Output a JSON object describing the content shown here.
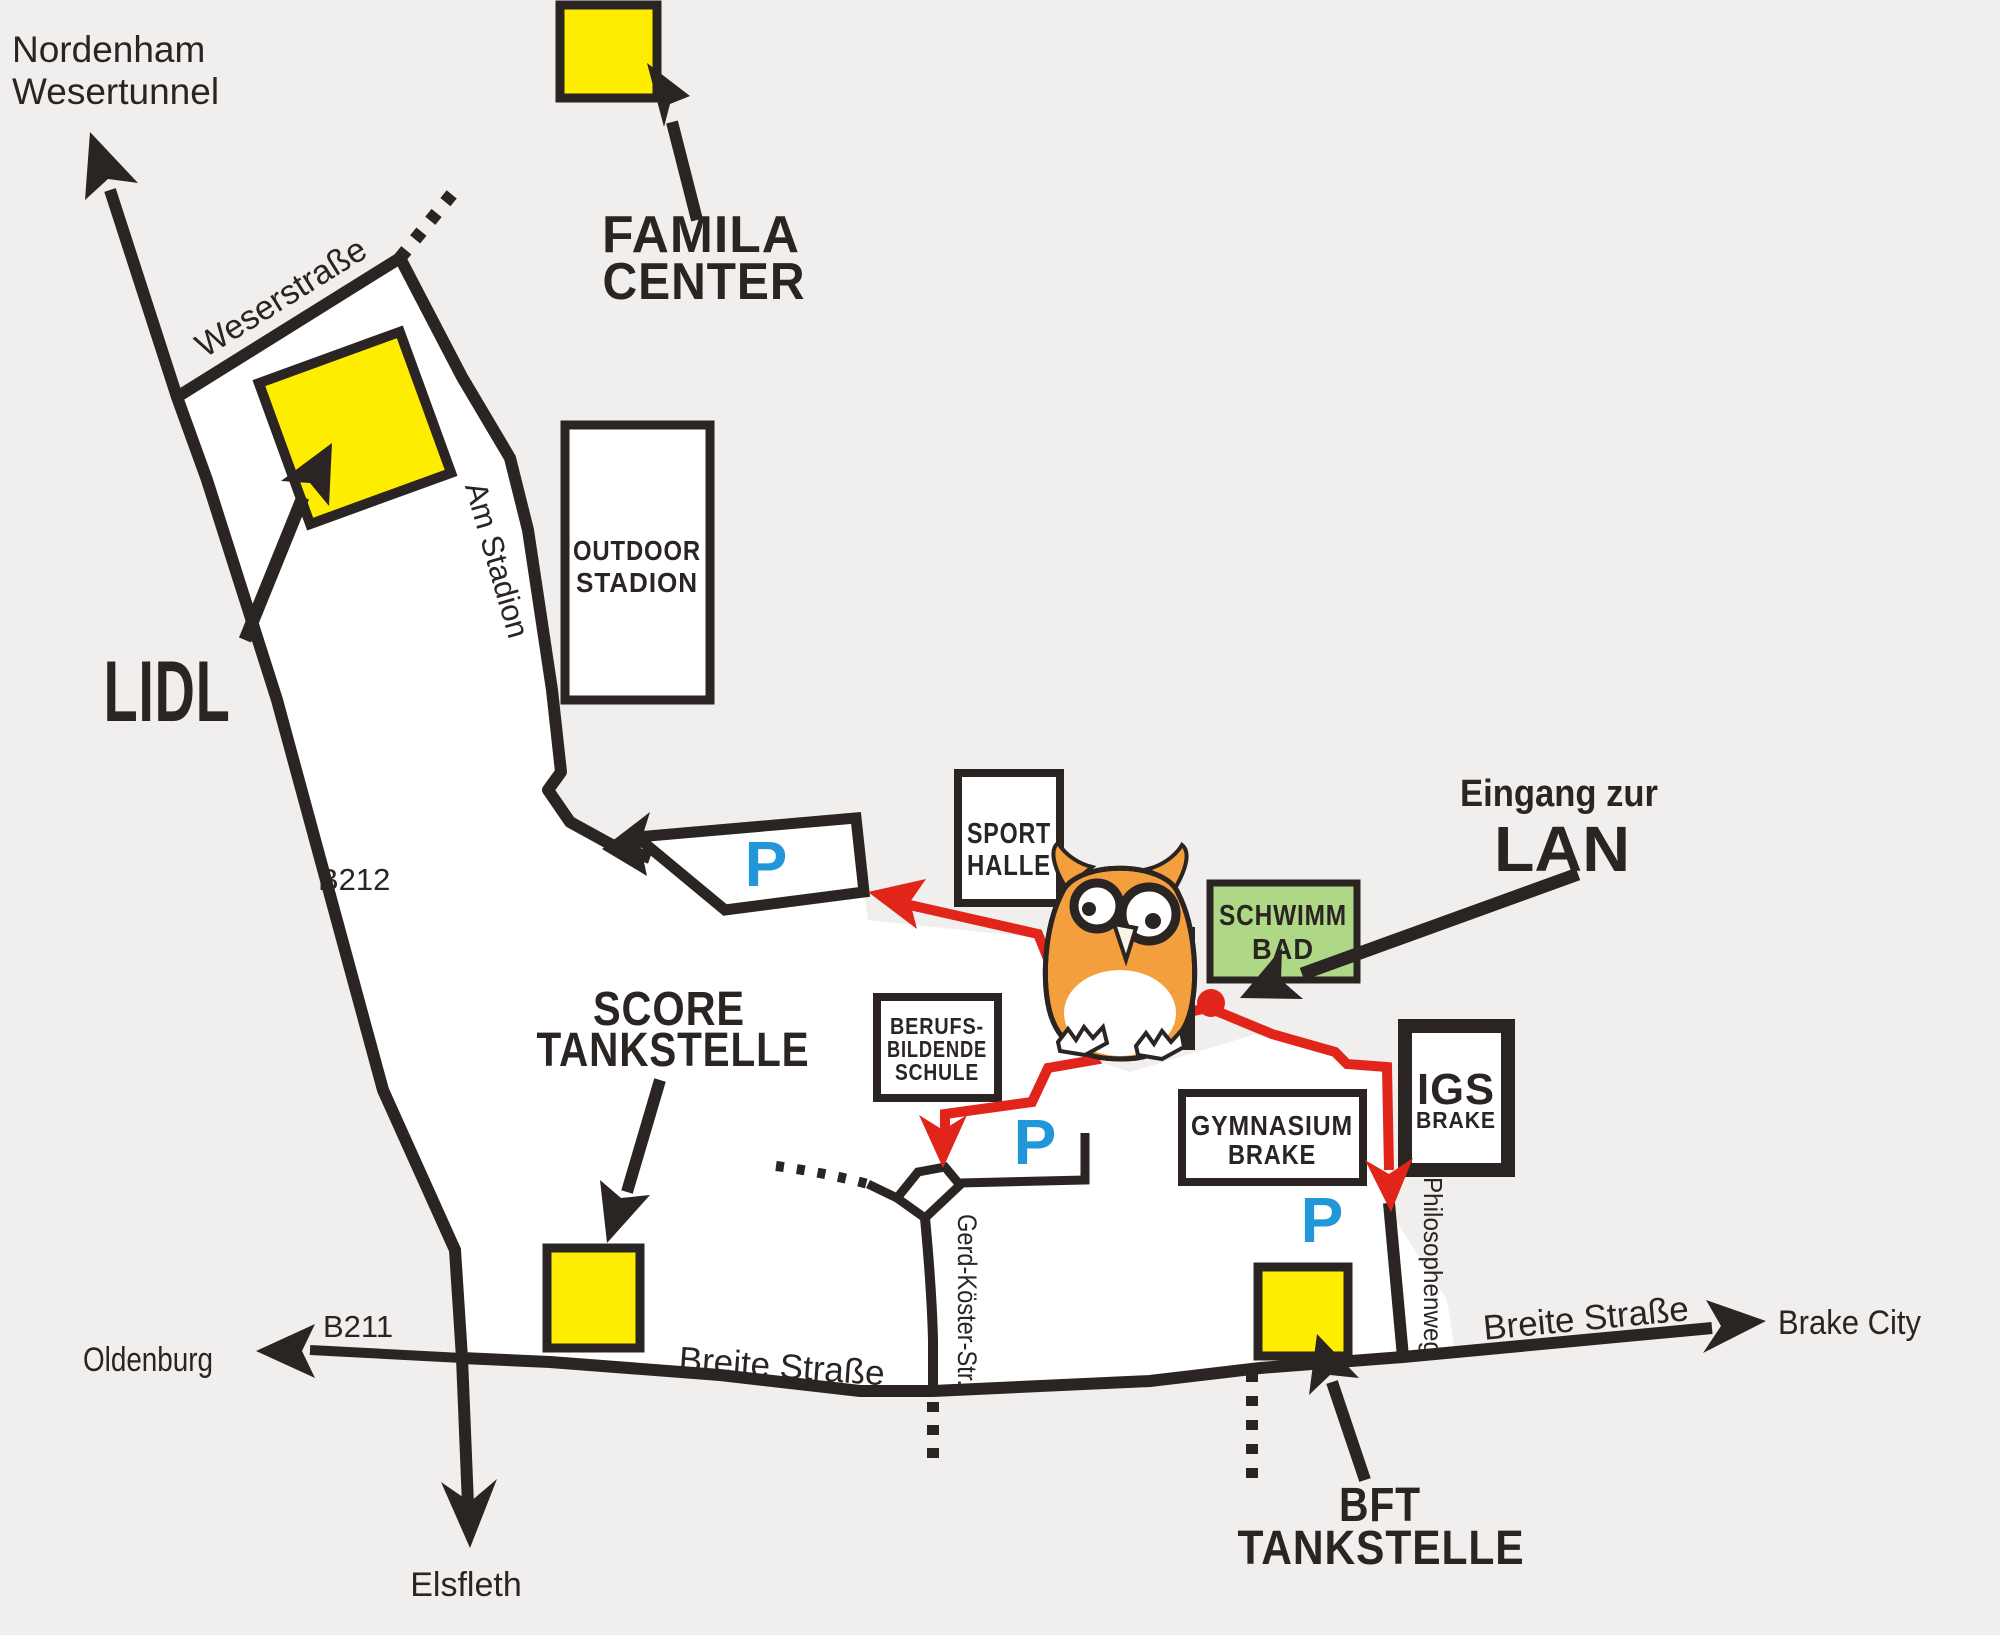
{
  "map_title_hint": "Anfahrtsskizze / directions map",
  "colors": {
    "ink": "#2a2422",
    "bg": "#f0efed",
    "white": "#ffffff",
    "yellow": "#ffed00",
    "red": "#e1251b",
    "blue": "#2196d8",
    "green": "#aed786",
    "orange": "#f49f3d",
    "cream": "#f8f4e8"
  },
  "destinations": {
    "nordenham_line1": "Nordenham",
    "nordenham_line2": "Wesertunnel",
    "oldenburg": "Oldenburg",
    "elsfleth": "Elsfleth",
    "brake_city": "Brake City"
  },
  "streets": {
    "weserstrasse": "Weserstraße",
    "am_stadion": "Am Stadion",
    "b212": "B212",
    "b211": "B211",
    "breite_strasse_west": "Breite Straße",
    "breite_strasse_east": "Breite Straße",
    "gerd_koester": "Gerd-Köster-Str.",
    "philosophenweg": "Philosophenweg"
  },
  "landmarks": {
    "famila": {
      "line1": "FAMILA",
      "line2": "CENTER"
    },
    "lidl": {
      "label": "LIDL"
    },
    "outdoor_stadion": {
      "line1": "OUTDOOR",
      "line2": "STADION"
    },
    "score": {
      "line1": "SCORE",
      "line2": "TANKSTELLE"
    },
    "sporthalle": {
      "line1": "SPORT",
      "line2": "HALLE"
    },
    "schwimmbad": {
      "line1": "SCHWIMM",
      "line2": "BAD"
    },
    "berufsschule": {
      "line1": "BERUFS-",
      "line2": "BILDENDE",
      "line3": "SCHULE"
    },
    "gymnasium": {
      "line1": "GYMNASIUM",
      "line2": "BRAKE"
    },
    "igs": {
      "line1": "IGS",
      "line2": "BRAKE"
    },
    "bft": {
      "line1": "BFT",
      "line2": "TANKSTELLE"
    }
  },
  "entrance": {
    "line1": "Eingang zur",
    "line2": "LAN"
  },
  "parking": {
    "symbol": "P"
  }
}
